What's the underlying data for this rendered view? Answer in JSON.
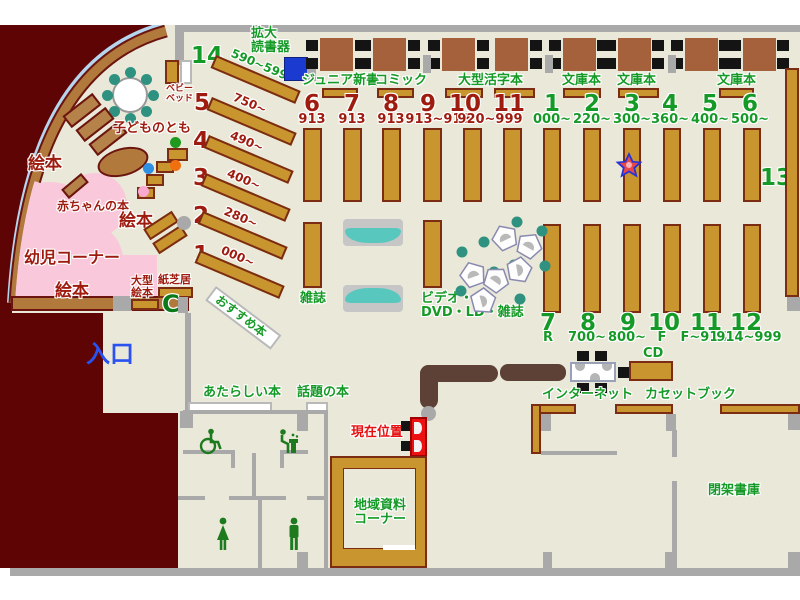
{
  "colors": {
    "floor": "#eae9d9",
    "wall_gray": "#a9a9a9",
    "maroon": "#5e0404",
    "wood": "#b1793b",
    "shelf_tan": "#c9952f",
    "pink": "#f9c9db",
    "teal": "#2f9180",
    "bench_teal": "#58c8bf",
    "text_green": "#169a27",
    "text_dark_red": "#9e1b0f",
    "text_red": "#e61010",
    "text_blue": "#2952f0",
    "magnifier_blue": "#1a3ad0",
    "counter_brown": "#5d4036",
    "star_outline": "#2433d8",
    "star_fill": "#e84848"
  },
  "top_row": {
    "magnifier_label": "拡大\n読書器",
    "sections": [
      "ジュニア新書",
      "コミック",
      "大型活字本",
      "文庫本",
      "文庫本",
      "文庫本"
    ]
  },
  "children_area": {
    "baby_bed": "ベビー\nベッド",
    "kodomonotomo": "子どものとも",
    "ehon_left": "絵本",
    "ehon_mid": "絵本",
    "ehon_bottom": "絵本",
    "akachan": "赤ちゃんの本",
    "youji_corner": "幼児コーナー",
    "oogata_ehon": "大型\n絵本",
    "kamishibai": "紙芝居",
    "phone_glyph": "C"
  },
  "entrance": "入口",
  "osusume": "おすすめ本",
  "diagonal_shelves": [
    {
      "num": "14",
      "range": "590~599"
    },
    {
      "num": "5",
      "range": "750~"
    },
    {
      "num": "4",
      "range": "490~"
    },
    {
      "num": "3",
      "range": "400~"
    },
    {
      "num": "2",
      "range": "280~"
    },
    {
      "num": "1",
      "range": "000~"
    }
  ],
  "left_shelves": {
    "numbers": [
      "6",
      "7",
      "8",
      "9",
      "10",
      "11"
    ],
    "ranges": [
      "913",
      "913",
      "913",
      "913~919",
      "920~999"
    ]
  },
  "right_shelves_top": {
    "numbers": [
      "1",
      "2",
      "3",
      "4",
      "5",
      "6"
    ],
    "ranges": [
      "000~",
      "220~",
      "300~",
      "360~",
      "400~",
      "500~"
    ]
  },
  "right_shelves_bottom": {
    "numbers": [
      "7",
      "8",
      "9",
      "10",
      "11",
      "12"
    ],
    "ranges": [
      "R",
      "700~",
      "800~",
      "F",
      "F~914",
      "914~999"
    ]
  },
  "shelf_13": "13",
  "mid_labels": {
    "zasshi": "雑誌",
    "video": "ビデオ・\nDVD・LD・雑誌"
  },
  "bottom": {
    "atarashii": "あたらしい本",
    "wadai": "話題の本",
    "genzai": "現在位置",
    "internet": "インターネット",
    "cd": "CD",
    "cassette": "カセットブック",
    "chiiki": "地域資料\nコーナー",
    "heika": "閉架書庫"
  }
}
